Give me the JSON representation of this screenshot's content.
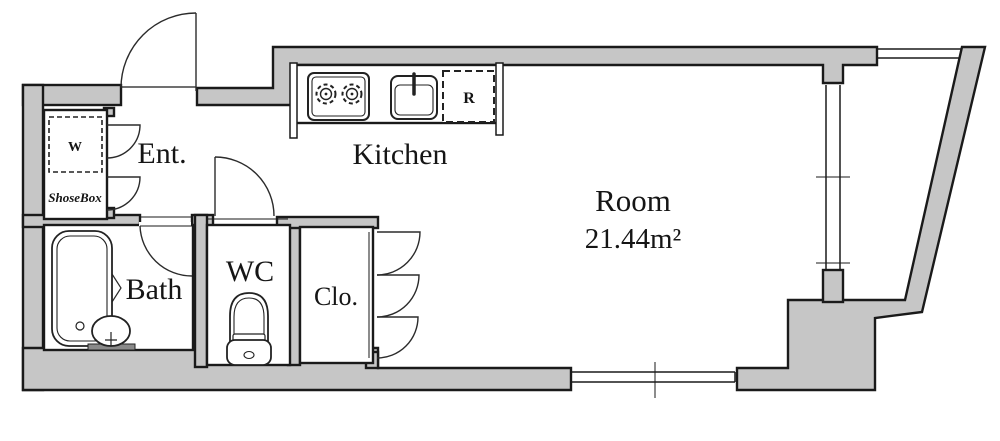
{
  "floor_plan": {
    "labels": {
      "entrance": "Ent.",
      "kitchen": "Kitchen",
      "room": "Room",
      "room_area": "21.44m²",
      "bath": "Bath",
      "wc": "WC",
      "closet": "Clo.",
      "shoe_box": "ShoseBox",
      "washer_symbol": "W",
      "refrigerator_symbol": "R"
    },
    "colors": {
      "wall_fill": "#c6c6c6",
      "line": "#1a1a1a",
      "background": "#ffffff"
    }
  }
}
